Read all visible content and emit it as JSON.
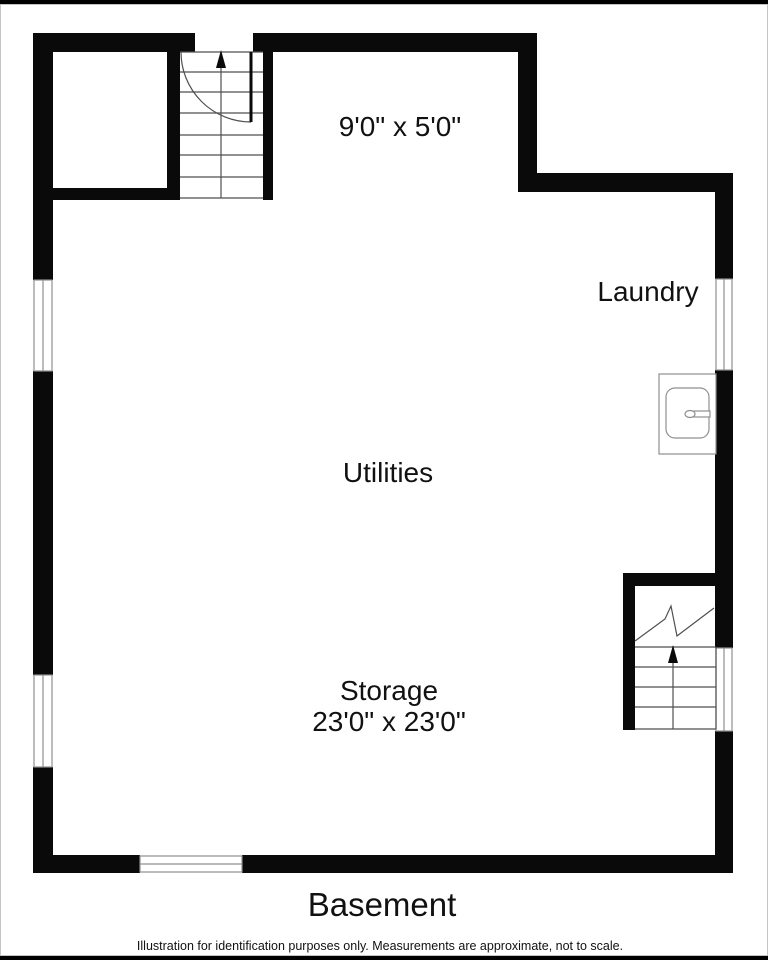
{
  "page": {
    "title": "Basement",
    "disclaimer": "Illustration for identification purposes only. Measurements are approximate, not to scale."
  },
  "rooms": {
    "top_area": {
      "dimensions": "9'0\" x 5'0\""
    },
    "laundry": {
      "name": "Laundry"
    },
    "utilities": {
      "name": "Utilities"
    },
    "storage": {
      "name": "Storage",
      "dimensions": "23'0\" x 23'0\""
    }
  },
  "symbols": {
    "stairs_top_left": "staircase-up-with-door-swing",
    "stairs_bottom_right": "staircase-up-with-break-line",
    "fixture": "laundry-sink",
    "windows": "window-symbol",
    "arrows": "stair-direction-up-arrow"
  },
  "colors": {
    "wall": "#0a0a0a",
    "stair_line": "#4f4f4f",
    "window_line": "#8f8f8f",
    "fixture_line": "#8f8f8f",
    "background": "#ffffff",
    "frame_bar": "#000000",
    "frame_border": "#c4c4c4",
    "text": "#111111"
  }
}
